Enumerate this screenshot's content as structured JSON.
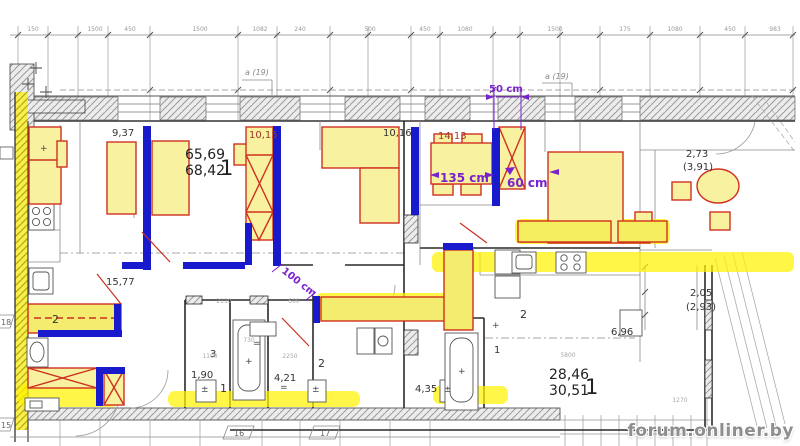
{
  "watermark": "forum.onliner.by",
  "rooms": {
    "area_937": "9,37",
    "area_6569": "65,69",
    "area_6842": "68,42",
    "apt1_no": "1",
    "area_1015": "10,15",
    "area_1016": "10,16",
    "area_1413": "14,13",
    "area_1577": "15,77",
    "counter_no": "2",
    "area_190": "1,90",
    "wc1_no": "3",
    "bath1_no": "1",
    "area_421": "4,21",
    "bath2_no": "2",
    "area_435": "4,35",
    "kitchen2_no": "2",
    "hall1_no": "1",
    "area_696": "6,96",
    "area_273": "2,73",
    "area_391": "(3,91)",
    "area_205": "2,05",
    "area_293": "(2,93)",
    "area_2846": "28,46",
    "area_3051": "30,51",
    "apt2_no": "1",
    "axis_a19_left": "a (19)",
    "axis_a19_right": "a (19)"
  },
  "tags": {
    "t15": "15",
    "t16": "16",
    "t17": "17",
    "t18": "18"
  },
  "annotations": {
    "d50": "50 cm",
    "d135": "135 cm",
    "d60": "60 cm",
    "d100": "100 cm"
  },
  "symbols": {
    "plus": "+",
    "plusminus": "±",
    "equals": "="
  },
  "dims_top": [
    "150",
    "1500",
    "450",
    "1500",
    "1082",
    "240",
    "500",
    "450",
    "1080",
    "1500",
    "175",
    "1080",
    "450",
    "983"
  ],
  "dims_inner": [
    "2110",
    "600",
    "730",
    "1100",
    "2250",
    "5800",
    "1270"
  ],
  "colors": {
    "furniture_fill": "#f7f1a0",
    "furniture_outline": "#d03020",
    "wall_blue": "#1a1acd",
    "highlight_yellow": "#fff200",
    "annotation_purple": "#7a22cc"
  }
}
